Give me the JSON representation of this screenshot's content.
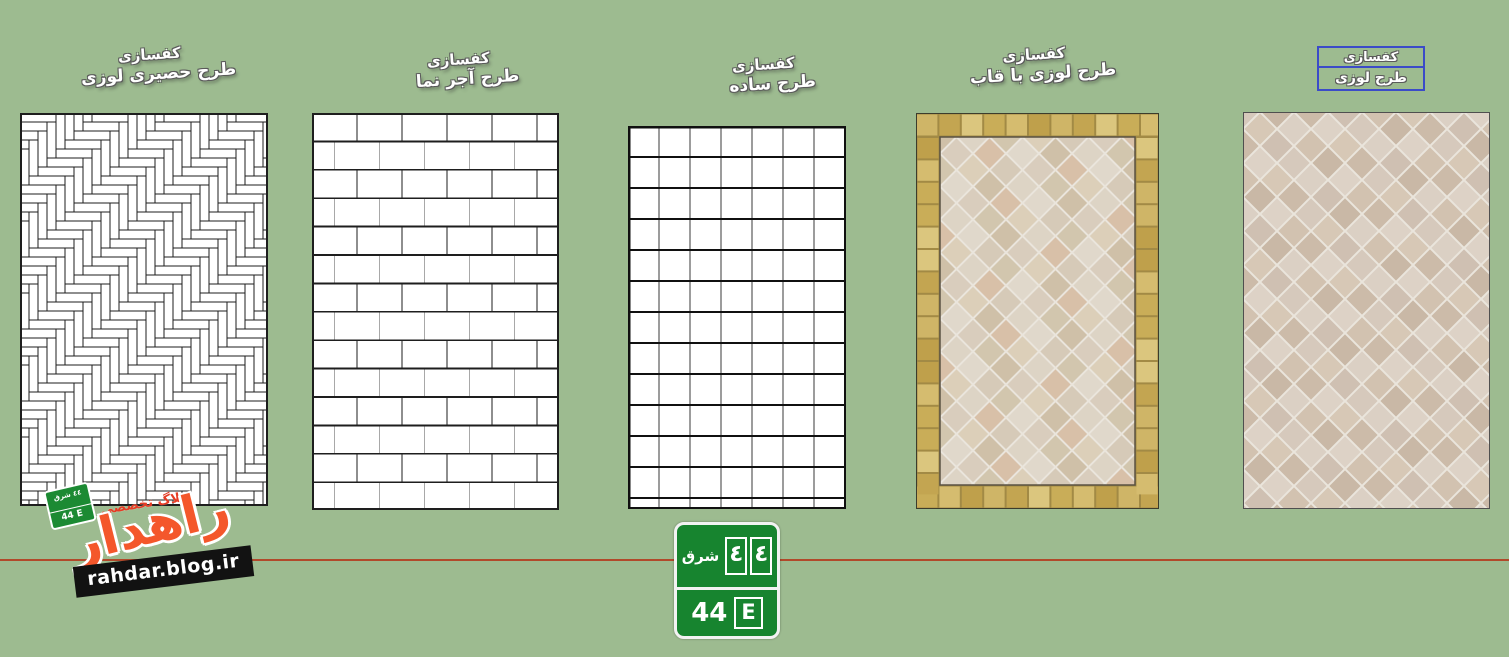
{
  "labels": [
    {
      "line1": "کفسازی",
      "line2": "طرح حصیری لوزی"
    },
    {
      "line1": "کفسازی",
      "line2": "طرح آجر نما"
    },
    {
      "line1": "کفسازی",
      "line2": "طرح ساده"
    },
    {
      "line1": "کفسازی",
      "line2": "طرح لوزی با قاب"
    },
    {
      "line1": "کفسازی",
      "line2": "طرح لوزی",
      "selected": true
    }
  ],
  "panels": [
    {
      "pattern": "herringbone-parquet"
    },
    {
      "pattern": "running-bond-brick"
    },
    {
      "pattern": "square-grid"
    },
    {
      "pattern": "diamond-tile-with-gold-frame"
    },
    {
      "pattern": "diamond-tile"
    }
  ],
  "sign": {
    "top_word": "شرق",
    "top_digit1": "٤",
    "top_digit2": "٤",
    "bottom_number": "44",
    "bottom_letter": "E"
  },
  "watermark": {
    "tagline": "وبلاگ تخصصی",
    "title": "راهدار",
    "url": "rahdar.blog.ir",
    "sign_top": "٤٤ شرق",
    "sign_bottom": "44 E"
  },
  "colors": {
    "background": "#9dbb90",
    "axis_line": "#b1492a",
    "sign_green": "#17842f",
    "selection_blue": "#3b4bc8",
    "watermark_orange": "#f4572b",
    "watermark_red": "#e63c25",
    "watermark_box_black": "#121212",
    "line_dark": "#1e1e1e",
    "line_gray": "#a8a8a8",
    "tile_white": "#ffffff",
    "grout_light": "#eae5dc",
    "gold_grout": "#a28a45",
    "gold_palette": [
      "#cfb567",
      "#c3a551",
      "#dbc67e",
      "#c9ad58",
      "#d5bc6f",
      "#bfa04b"
    ],
    "tile_palette_framed": [
      "#ddd4c5",
      "#d6cab8",
      "#e0d8cb",
      "#d2c6ae",
      "#d9cdbd",
      "#cfc0a8",
      "#dccfb9",
      "#d8c0a8"
    ],
    "tile_palette_plain": [
      "#d6c9bc",
      "#cfc0b2",
      "#dbd0c4",
      "#c9b8a6",
      "#d2c2b0",
      "#ddd2c6",
      "#ccbba9",
      "#d7c8b6"
    ]
  }
}
